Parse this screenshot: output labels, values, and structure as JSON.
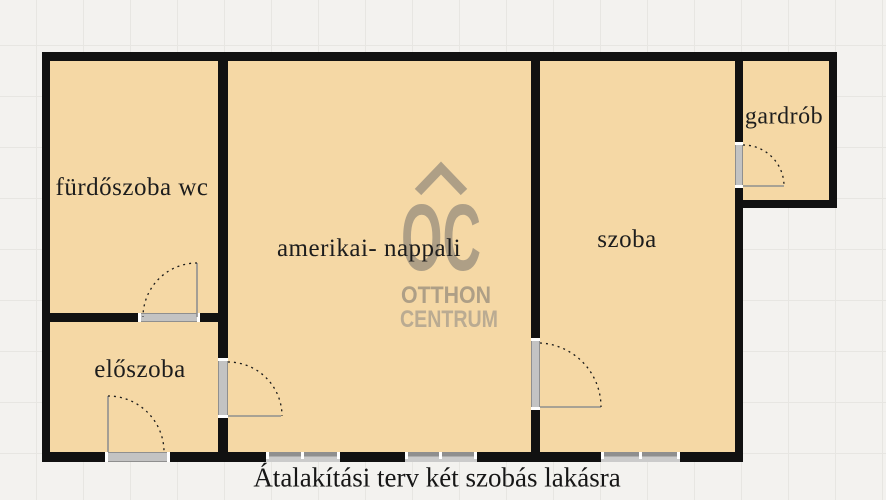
{
  "floorplan": {
    "caption": "Átalakítási terv két szobás lakásra",
    "rooms": {
      "bathroom": {
        "label": "fürdőszoba wc"
      },
      "hall": {
        "label": "előszoba"
      },
      "living": {
        "label": "amerikai- nappali"
      },
      "bedroom": {
        "label": "szoba"
      },
      "wardrobe": {
        "label": "gardrób"
      }
    },
    "watermark": {
      "monogram": "OC",
      "brand_line1": "OTTHON",
      "brand_line2": "CENTRUM"
    },
    "colors": {
      "floor": "#f5d8a5",
      "wall": "#111111",
      "watermark": "#ab9d85",
      "background": "#f3f2ef",
      "grid_line": "#e7e6e2",
      "door_frame": "#c3c3c3",
      "window_gray": "#8f8f8f",
      "text": "#1d1d1d"
    }
  }
}
